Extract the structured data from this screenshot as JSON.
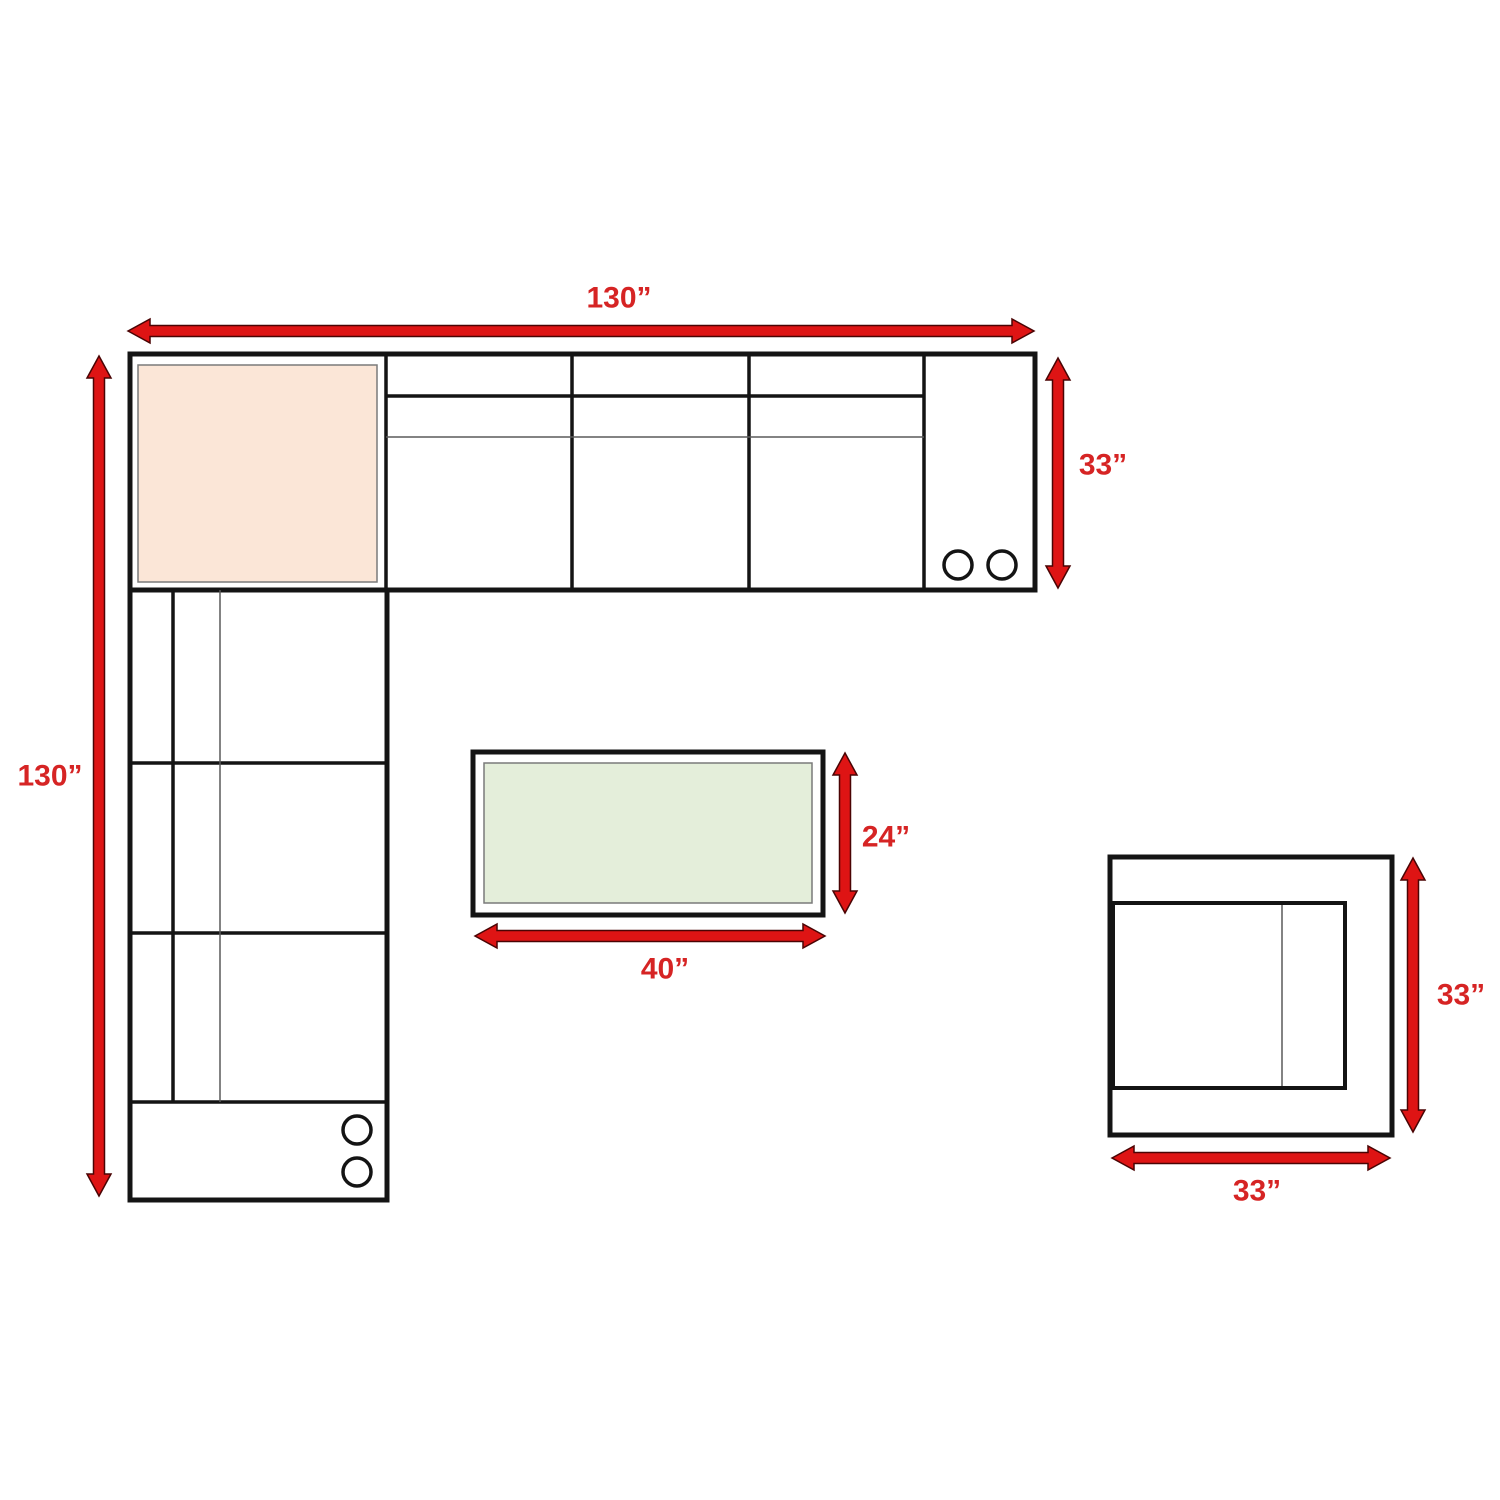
{
  "diagram": {
    "description": "furniture-dimension-plan",
    "pieces": {
      "sectional_sofa": {
        "width_label": "130”",
        "height_label": "130”",
        "depth_label": "33”"
      },
      "coffee_table": {
        "width_label": "40”",
        "depth_label": "24”"
      },
      "chair": {
        "width_label": "33”",
        "height_label": "33”"
      }
    },
    "colors": {
      "arrow_red": "#de1414",
      "label_red": "#d62424",
      "outline_black": "#141414",
      "detail_gray": "#5a5a5a",
      "sectional_corner_fill": "#fbe6d7",
      "coffee_table_fill": "#e4eeda"
    }
  }
}
